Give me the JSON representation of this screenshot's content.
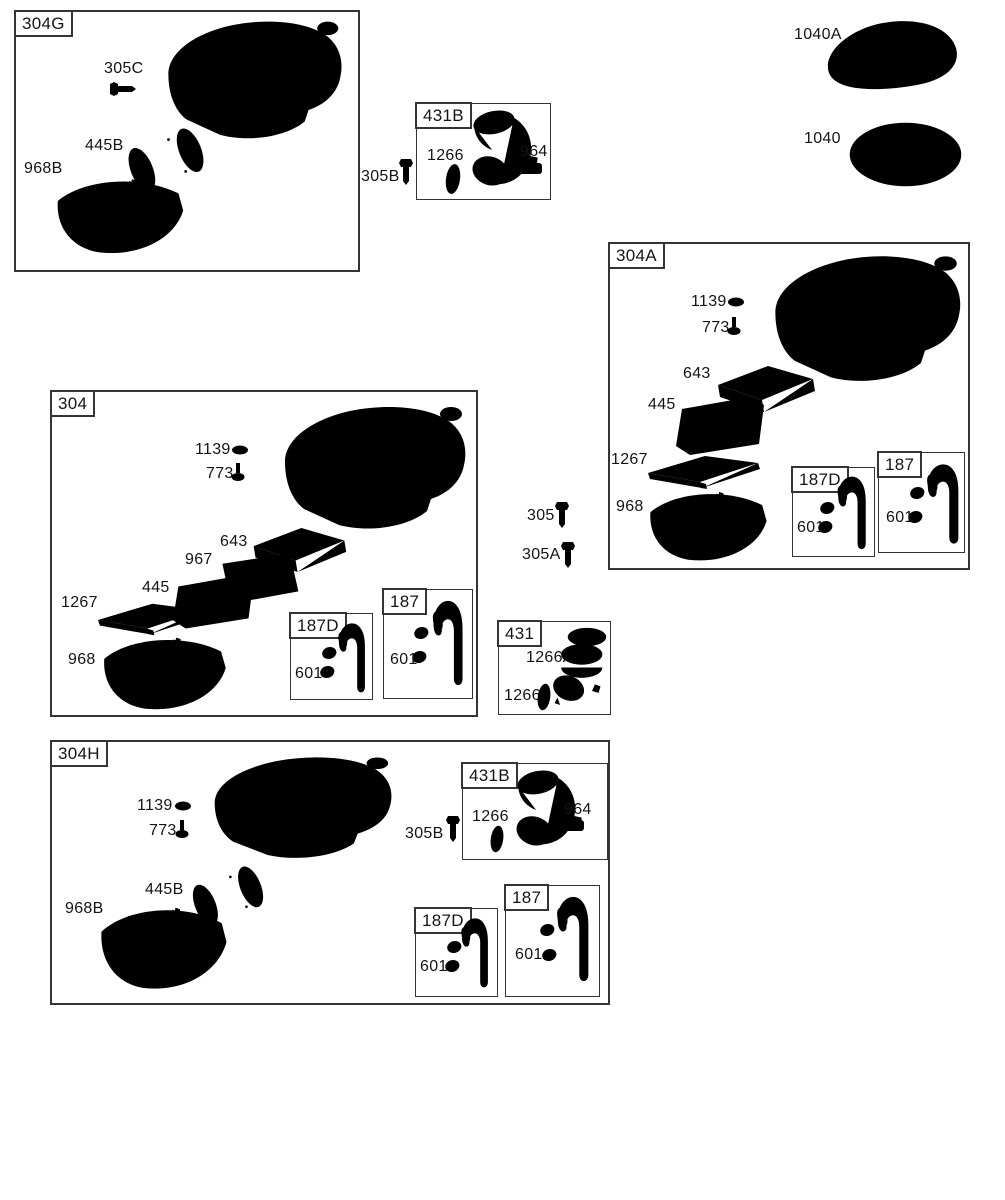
{
  "colors": {
    "ink": "#343434",
    "paper": "#ffffff"
  },
  "groups": {
    "g304G": {
      "tag": "304G",
      "p305C": "305C",
      "p445B": "445B",
      "p968B": "968B"
    },
    "g431Btop": {
      "tag": "431B",
      "p1266": "1266",
      "p964": "964"
    },
    "g304A": {
      "tag": "304A",
      "p1139": "1139",
      "p773": "773",
      "p643": "643",
      "p445": "445",
      "p1267": "1267",
      "p968": "968",
      "g187D": {
        "tag": "187D",
        "p601": "601"
      },
      "g187": {
        "tag": "187",
        "p601": "601"
      }
    },
    "g304": {
      "tag": "304",
      "p1139": "1139",
      "p773": "773",
      "p643": "643",
      "p967": "967",
      "p445": "445",
      "p1267": "1267",
      "p968": "968",
      "g187D": {
        "tag": "187D",
        "p601": "601"
      },
      "g187": {
        "tag": "187",
        "p601": "601"
      }
    },
    "g431": {
      "tag": "431",
      "p1266A": "1266A",
      "p1266": "1266"
    },
    "g304H": {
      "tag": "304H",
      "p1139": "1139",
      "p773": "773",
      "p445B": "445B",
      "p968B": "968B",
      "p305B": "305B",
      "g431B": {
        "tag": "431B",
        "p1266": "1266",
        "p964": "964"
      },
      "g187D": {
        "tag": "187D",
        "p601": "601"
      },
      "g187": {
        "tag": "187",
        "p601": "601"
      }
    }
  },
  "loose": {
    "p305B": "305B",
    "p1040A": "1040A",
    "p1040": "1040",
    "p305": "305",
    "p305A": "305A"
  }
}
